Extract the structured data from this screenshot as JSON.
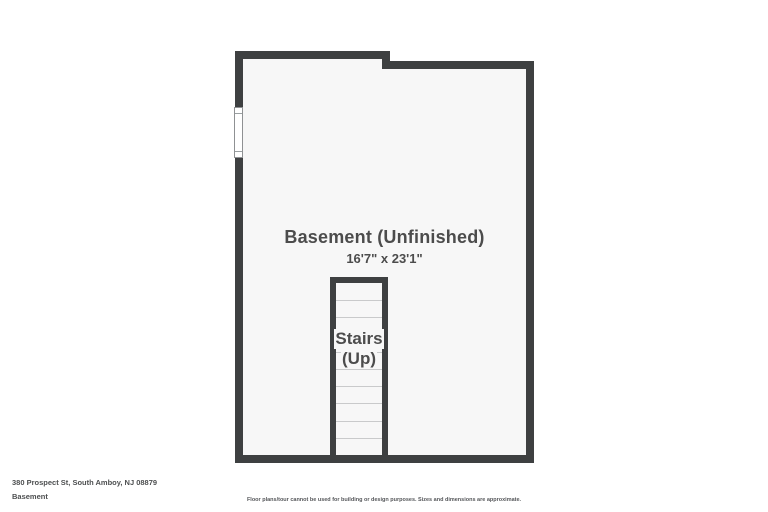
{
  "colors": {
    "page": "#ffffff",
    "wall": "#3e4041",
    "floor": "#f7f7f7",
    "tread_line": "#c9cacb",
    "text": "#4c4c4c"
  },
  "floorplan": {
    "room": {
      "label": "Basement (Unfinished)",
      "dimensions": "16'7\" x 23'1\""
    },
    "stairs": {
      "label_line1": "Stairs",
      "label_line2": "(Up)",
      "tread_count": 10
    }
  },
  "footer": {
    "address": "380 Prospect St, South Amboy, NJ 08879",
    "floor_name": "Basement",
    "disclaimer": "Floor plans/tour cannot be used for building or design purposes. Sizes and dimensions are approximate."
  }
}
